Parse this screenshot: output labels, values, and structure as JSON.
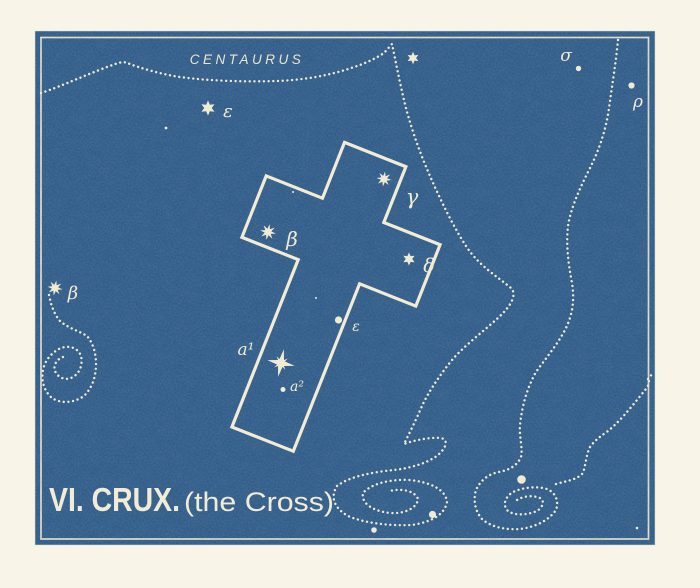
{
  "plate": {
    "title": {
      "main": "VI. CRUX.",
      "subtitle": "(the Cross)"
    },
    "neighbor_constellation": "CENTAURUS",
    "labels": {
      "epsilon_centauri": "ε",
      "sigma": "σ",
      "rho": "ρ",
      "gamma": "γ",
      "beta": "β",
      "delta": "δ",
      "epsilon": "ε",
      "alpha1": "a¹",
      "alpha2": "a²",
      "beta_outer": "β"
    },
    "colors": {
      "plate_blue": "#2d5a88",
      "ink_cream": "#f1ebd2",
      "page": "#f8f5e8"
    }
  }
}
